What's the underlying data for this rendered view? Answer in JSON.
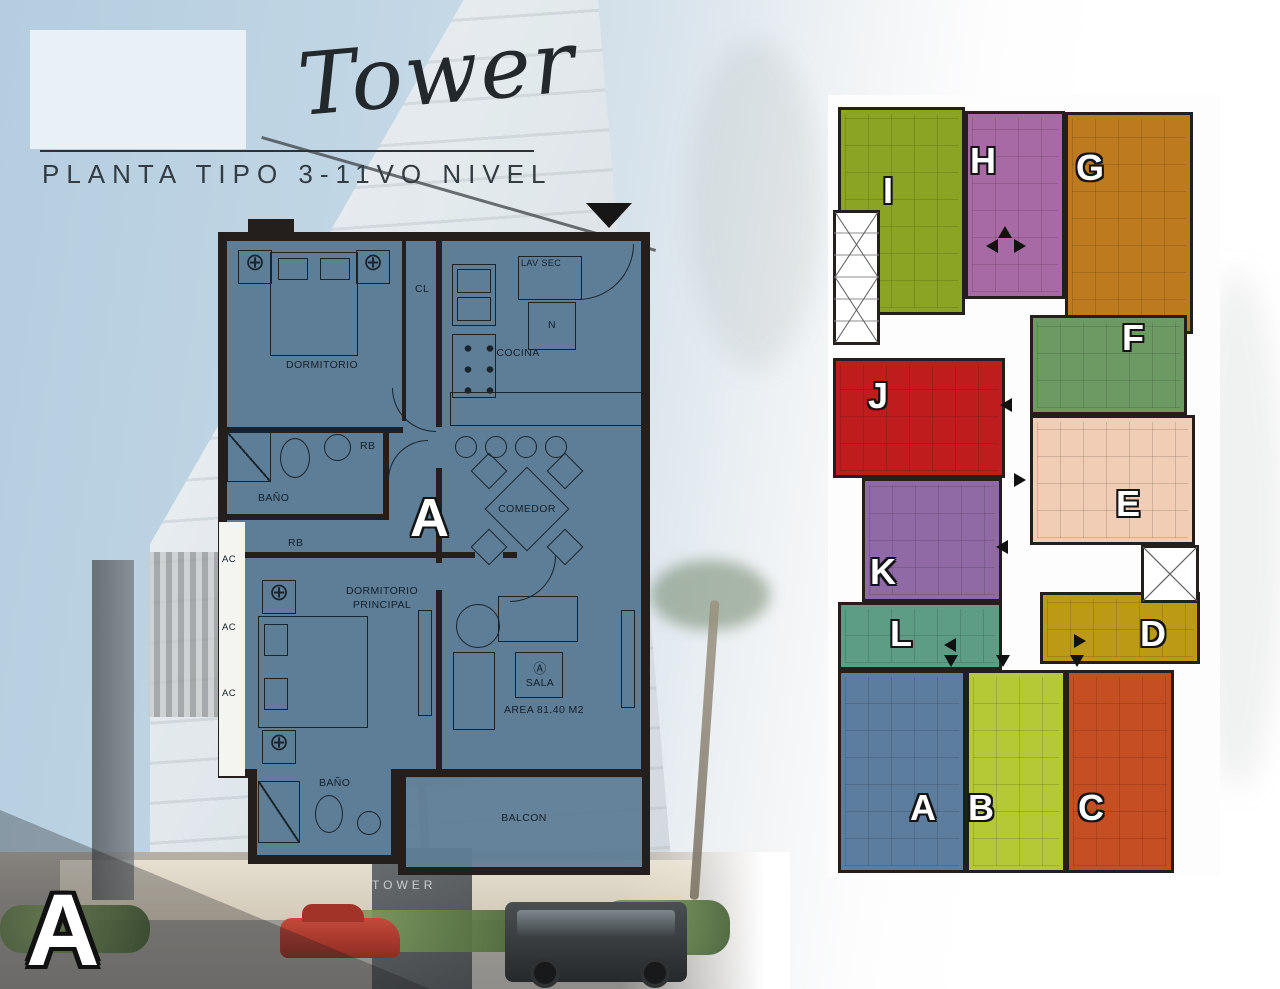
{
  "header": {
    "title": "Tower",
    "subtitle": "PLANTA TIPO 3-11VO NIVEL"
  },
  "unit_plan": {
    "unit_letter": "A",
    "labels": {
      "dormitorio": "DORMITORIO",
      "cl": "CL",
      "cocina": "COCINA",
      "lav_sec": "LAV SEC",
      "nevera": "N",
      "bano": "BAÑO",
      "rb": "RB",
      "comedor": "COMEDOR",
      "dormitorio_principal_1": "DORMITORIO",
      "dormitorio_principal_2": "PRINCIPAL",
      "ac": "AC",
      "sala_marker": "Ⓐ",
      "sala": "SALA",
      "area": "AREA 81.40 M2",
      "balcon": "BALCON",
      "fixture_symbol": "⊕"
    }
  },
  "key_plan": {
    "units": [
      {
        "letter": "I",
        "color": "#8ca423"
      },
      {
        "letter": "H",
        "color": "#a86aa4"
      },
      {
        "letter": "G",
        "color": "#bd7a1f"
      },
      {
        "letter": "F",
        "color": "#6d9a62"
      },
      {
        "letter": "J",
        "color": "#bf1d1d"
      },
      {
        "letter": "E",
        "color": "#f0cdb4"
      },
      {
        "letter": "K",
        "color": "#8f6aa5"
      },
      {
        "letter": "L",
        "color": "#5d9c85"
      },
      {
        "letter": "D",
        "color": "#bd9a15"
      },
      {
        "letter": "A",
        "color": "#5c7d9e"
      },
      {
        "letter": "B",
        "color": "#b5c937"
      },
      {
        "letter": "C",
        "color": "#c54e22"
      }
    ]
  },
  "corner_letter": "A",
  "building_sign": "TOWER",
  "colors": {
    "plan_fill": "#5e7d96",
    "wall": "#241f1c",
    "sky": "#b4cddf"
  }
}
